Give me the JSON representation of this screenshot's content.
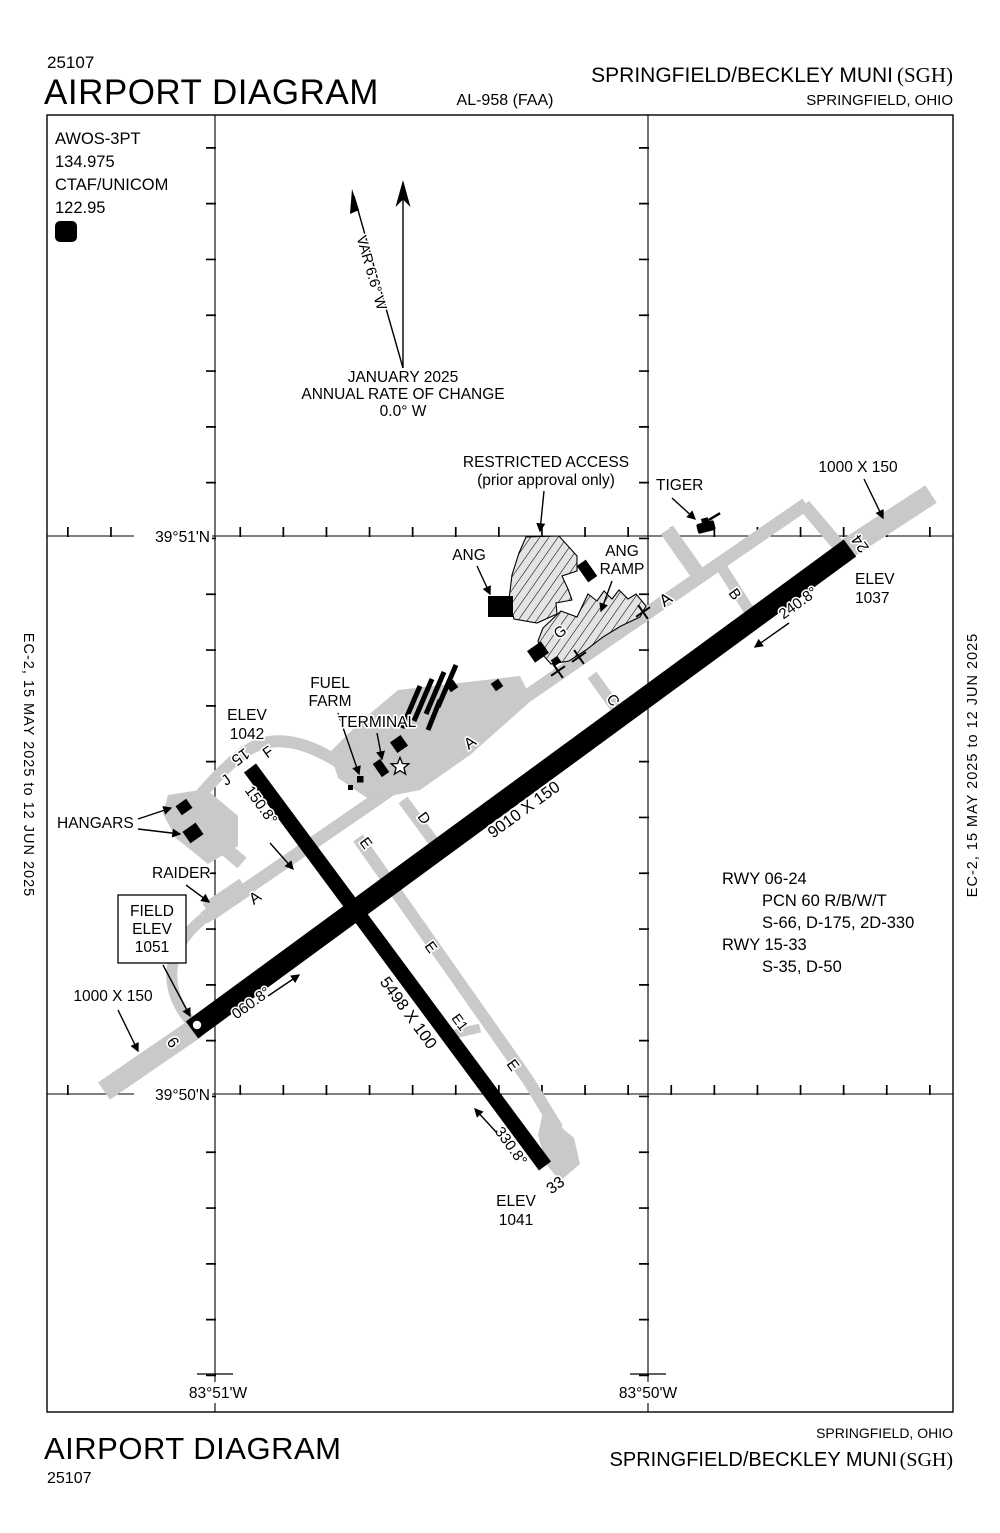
{
  "header": {
    "chart_number": "25107",
    "title": "AIRPORT DIAGRAM",
    "al_number": "AL-958 (FAA)",
    "airport_name": "SPRINGFIELD/BECKLEY MUNI",
    "airport_icao": "(SGH)",
    "city": "SPRINGFIELD, OHIO"
  },
  "footer": {
    "chart_number": "25107",
    "title": "AIRPORT DIAGRAM",
    "airport_name": "SPRINGFIELD/BECKLEY MUNI",
    "airport_icao": "(SGH)",
    "city": "SPRINGFIELD, OHIO"
  },
  "sidebar": {
    "left": "EC-2,  15 MAY 2025  to  12 JUN 2025",
    "right": "EC-2,  15 MAY 2025  to  12 JUN 2025"
  },
  "comm": {
    "line1": "AWOS-3PT",
    "line2": "134.975",
    "line3": "CTAF/UNICOM",
    "line4": "122.95",
    "d_symbol": "D"
  },
  "north": {
    "variation": "VAR 6.6° W",
    "date": "JANUARY 2025",
    "rate_label": "ANNUAL RATE OF CHANGE",
    "rate_value": "0.0° W"
  },
  "grid": {
    "lat_top": "39°51'N",
    "lat_bottom": "39°50'N",
    "lon_left": "83°51'W",
    "lon_right": "83°50'W"
  },
  "rwy_info": {
    "lines": [
      "RWY 06-24",
      "PCN 60 R/B/W/T",
      "S-66, D-175, 2D-330",
      "RWY 15-33",
      "S-35, D-50"
    ]
  },
  "map": {
    "restricted1": "RESTRICTED ACCESS",
    "restricted2": "(prior approval only)",
    "tiger": "TIGER",
    "overrun_ne": "1000 X 150",
    "overrun_sw": "1000 X 150",
    "ang": "ANG",
    "ramp1": "ANG",
    "ramp2": "RAMP",
    "elev24_1": "ELEV",
    "elev24_2": "1037",
    "hdg24": "240.8°",
    "hdg06": "060.8°",
    "hdg15": "150.8°",
    "hdg33": "330.8°",
    "num24": "24",
    "num06": "6",
    "num15": "15",
    "num33": "33",
    "dim0624": "9010 X 150",
    "dim1533": "5498 X 100",
    "fuel1": "FUEL",
    "fuel2": "FARM",
    "terminal": "TERMINAL",
    "elev15_1": "ELEV",
    "elev15_2": "1042",
    "hangars": "HANGARS",
    "raider": "RAIDER",
    "field1": "FIELD",
    "field2": "ELEV",
    "field3": "1051",
    "elev33_1": "ELEV",
    "elev33_2": "1041"
  },
  "taxiways": {
    "a1": "A",
    "a2": "A",
    "a3": "A",
    "b": "B",
    "c": "C",
    "d": "D",
    "e1": "E",
    "e2": "E",
    "e3": "E",
    "e1c": "E1",
    "f": "F",
    "g": "G",
    "j": "J"
  },
  "colors": {
    "pavement_gray": "#c9c9c9",
    "ink": "#000000"
  }
}
